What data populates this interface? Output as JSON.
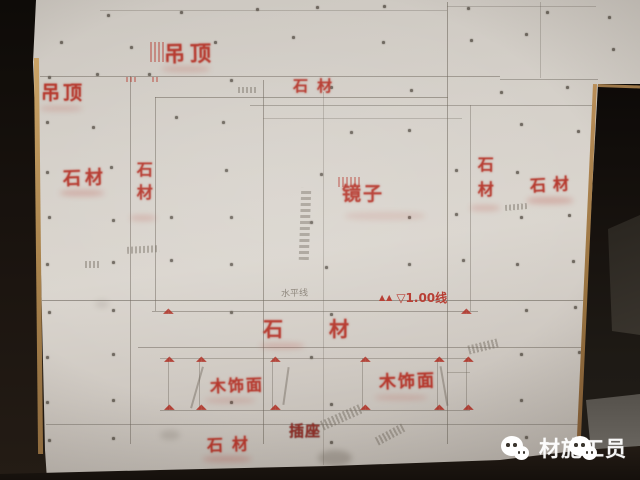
{
  "colors": {
    "stencil_red": "#b5372c",
    "stencil_dark_red": "#8f2d26",
    "pencil_gray": "#6f675c",
    "wall_light": "#dad5ce",
    "wall_dark": "#b3ada6",
    "shadow_black": "#16110d",
    "wood_trim": "#a8824c",
    "floor_gray": "#6a6660",
    "watermark_white": "#ffffff"
  },
  "stencil_labels": [
    {
      "id": "diaoding-top",
      "text": "吊顶",
      "x": 164,
      "y": 43,
      "fs": 21,
      "ls": 5,
      "rot": -1
    },
    {
      "id": "diaoding-left",
      "text": "吊顶",
      "x": 41,
      "y": 84,
      "fs": 19,
      "ls": 3,
      "rot": 0
    },
    {
      "id": "shicai-top",
      "text": "石材",
      "x": 293,
      "y": 79,
      "fs": 15,
      "ls": 9,
      "rot": 0
    },
    {
      "id": "shicai-left-horizontal",
      "text": "石材",
      "x": 63,
      "y": 170,
      "fs": 18,
      "ls": 4,
      "rot": -2
    },
    {
      "id": "shicai-left-vertical",
      "text": "石材",
      "x": 134,
      "y": 161,
      "fs": 16,
      "ls": 7,
      "vert": true
    },
    {
      "id": "jingzi-mirror",
      "text": "镜子",
      "x": 342,
      "y": 185,
      "fs": 19,
      "ls": 2,
      "rot": 0
    },
    {
      "id": "shicai-right-vertical",
      "text": "石材",
      "x": 475,
      "y": 156,
      "fs": 16,
      "ls": 9,
      "vert": true
    },
    {
      "id": "shicai-right-horizontal",
      "text": "石材",
      "x": 530,
      "y": 177,
      "fs": 16,
      "ls": 7,
      "rot": -3
    },
    {
      "id": "shicai-middle-band",
      "text": "石材",
      "x": 263,
      "y": 319,
      "fs": 20,
      "ls": 46,
      "rot": 0
    },
    {
      "id": "mushimian-left",
      "text": "木饰面",
      "x": 210,
      "y": 378,
      "fs": 16,
      "ls": 2,
      "rot": -2
    },
    {
      "id": "mushimian-right",
      "text": "木饰面",
      "x": 379,
      "y": 374,
      "fs": 17,
      "ls": 2,
      "rot": -2
    },
    {
      "id": "chazuo-socket",
      "text": "插座",
      "x": 289,
      "y": 424,
      "fs": 15,
      "ls": 1,
      "rot": 0,
      "dark": true
    },
    {
      "id": "shicai-bottom",
      "text": "石材",
      "x": 207,
      "y": 437,
      "fs": 16,
      "ls": 9,
      "rot": -2
    }
  ],
  "level_mark": {
    "symbols": "▲▲",
    "text": "▽1.00线"
  },
  "pencil_note": {
    "text": "水平线"
  },
  "watermark": {
    "text": "材施工员",
    "icons": [
      "wechat-icon",
      "wechat-icon"
    ]
  },
  "wall": {
    "corner_mark_glyph": "◢◣",
    "corner_marks": [
      [
        163,
        308
      ],
      [
        461,
        308
      ],
      [
        164,
        356
      ],
      [
        196,
        356
      ],
      [
        270,
        356
      ],
      [
        360,
        356
      ],
      [
        434,
        356
      ],
      [
        463,
        356
      ],
      [
        164,
        404
      ],
      [
        196,
        404
      ],
      [
        270,
        404
      ],
      [
        360,
        404
      ],
      [
        434,
        404
      ],
      [
        463,
        404
      ]
    ],
    "lines_h": [
      [
        10,
        100,
        447,
        0.3
      ],
      [
        6,
        447,
        596,
        0.3
      ],
      [
        76,
        40,
        500,
        0.5
      ],
      [
        79,
        500,
        598,
        0.45
      ],
      [
        97,
        155,
        448,
        0.55
      ],
      [
        105,
        250,
        592,
        0.45
      ],
      [
        118,
        263,
        462,
        0.3
      ],
      [
        300,
        42,
        590,
        0.6
      ],
      [
        311,
        152,
        478,
        0.5
      ],
      [
        347,
        138,
        588,
        0.5
      ],
      [
        358,
        160,
        470,
        0.4
      ],
      [
        372,
        447,
        470,
        0.35
      ],
      [
        410,
        160,
        470,
        0.45
      ],
      [
        424,
        46,
        580,
        0.45
      ]
    ],
    "lines_v": [
      [
        130,
        76,
        444,
        0.5
      ],
      [
        155,
        97,
        311,
        0.5
      ],
      [
        263,
        80,
        444,
        0.55
      ],
      [
        323,
        92,
        465,
        0.3
      ],
      [
        447,
        2,
        444,
        0.55
      ],
      [
        470,
        105,
        311,
        0.4
      ],
      [
        540,
        2,
        78,
        0.3
      ],
      [
        168,
        358,
        410,
        0.4
      ],
      [
        199,
        358,
        410,
        0.4
      ],
      [
        272,
        358,
        410,
        0.4
      ],
      [
        362,
        358,
        410,
        0.4
      ],
      [
        437,
        358,
        410,
        0.4
      ],
      [
        466,
        358,
        410,
        0.4
      ]
    ],
    "screws": [
      [
        107,
        14
      ],
      [
        180,
        11
      ],
      [
        256,
        8
      ],
      [
        316,
        6
      ],
      [
        383,
        5
      ],
      [
        467,
        7
      ],
      [
        546,
        11
      ],
      [
        608,
        16
      ],
      [
        60,
        41
      ],
      [
        130,
        46
      ],
      [
        214,
        41
      ],
      [
        292,
        36
      ],
      [
        382,
        41
      ],
      [
        470,
        39
      ],
      [
        525,
        33
      ],
      [
        612,
        48
      ],
      [
        48,
        76
      ],
      [
        96,
        73
      ],
      [
        148,
        73
      ],
      [
        230,
        79
      ],
      [
        330,
        86
      ],
      [
        410,
        89
      ],
      [
        500,
        91
      ],
      [
        566,
        86
      ],
      [
        46,
        121
      ],
      [
        92,
        126
      ],
      [
        175,
        116
      ],
      [
        222,
        121
      ],
      [
        350,
        131
      ],
      [
        408,
        129
      ],
      [
        520,
        123
      ],
      [
        577,
        130
      ],
      [
        46,
        171
      ],
      [
        110,
        166
      ],
      [
        225,
        169
      ],
      [
        320,
        173
      ],
      [
        455,
        169
      ],
      [
        516,
        171
      ],
      [
        48,
        216
      ],
      [
        112,
        219
      ],
      [
        170,
        216
      ],
      [
        230,
        216
      ],
      [
        310,
        221
      ],
      [
        408,
        216
      ],
      [
        455,
        213
      ],
      [
        520,
        216
      ],
      [
        568,
        214
      ],
      [
        46,
        263
      ],
      [
        112,
        261
      ],
      [
        170,
        259
      ],
      [
        230,
        263
      ],
      [
        325,
        266
      ],
      [
        408,
        263
      ],
      [
        462,
        259
      ],
      [
        516,
        263
      ],
      [
        572,
        260
      ],
      [
        48,
        311
      ],
      [
        112,
        309
      ],
      [
        230,
        311
      ],
      [
        330,
        313
      ],
      [
        525,
        309
      ],
      [
        574,
        306
      ],
      [
        46,
        356
      ],
      [
        112,
        353
      ],
      [
        310,
        356
      ],
      [
        520,
        353
      ],
      [
        578,
        351
      ],
      [
        46,
        401
      ],
      [
        112,
        399
      ],
      [
        230,
        401
      ],
      [
        330,
        403
      ],
      [
        520,
        399
      ],
      [
        48,
        439
      ],
      [
        112,
        437
      ],
      [
        330,
        441
      ],
      [
        525,
        436
      ]
    ],
    "smears": [
      [
        60,
        190,
        44,
        6,
        0.25
      ],
      [
        130,
        215,
        26,
        6,
        0.2
      ],
      [
        345,
        212,
        80,
        8,
        0.12
      ],
      [
        527,
        197,
        46,
        7,
        0.25
      ],
      [
        470,
        205,
        30,
        6,
        0.2
      ],
      [
        162,
        66,
        48,
        6,
        0.2
      ],
      [
        40,
        106,
        42,
        5,
        0.2
      ],
      [
        260,
        343,
        44,
        6,
        0.2
      ],
      [
        203,
        456,
        48,
        6,
        0.25
      ],
      [
        205,
        398,
        50,
        5,
        0.18
      ],
      [
        375,
        395,
        52,
        5,
        0.18
      ]
    ],
    "stains": [
      [
        318,
        450,
        34,
        16,
        0.35
      ],
      [
        160,
        430,
        20,
        10,
        0.2
      ],
      [
        95,
        300,
        14,
        8,
        0.15
      ]
    ],
    "scribbles": [
      {
        "x": 300,
        "y": 188,
        "w": 10,
        "h": 72,
        "rot": 2,
        "vert": true
      },
      {
        "x": 127,
        "y": 246,
        "w": 32,
        "h": 7,
        "rot": -3
      },
      {
        "x": 85,
        "y": 261,
        "w": 14,
        "h": 7,
        "rot": 0
      },
      {
        "x": 238,
        "y": 87,
        "w": 18,
        "h": 6,
        "rot": 0
      },
      {
        "x": 505,
        "y": 204,
        "w": 22,
        "h": 6,
        "rot": -5
      },
      {
        "x": 320,
        "y": 412,
        "w": 44,
        "h": 10,
        "rot": -24
      },
      {
        "x": 468,
        "y": 342,
        "w": 30,
        "h": 9,
        "rot": -14
      },
      {
        "x": 375,
        "y": 430,
        "w": 30,
        "h": 9,
        "rot": -28
      },
      {
        "x": 338,
        "y": 177,
        "w": 24,
        "h": 10,
        "rot": 0,
        "red": true
      },
      {
        "x": 150,
        "y": 42,
        "w": 16,
        "h": 20,
        "rot": 0,
        "red": true,
        "vert": true
      },
      {
        "x": 126,
        "y": 77,
        "w": 10,
        "h": 5,
        "rot": 0,
        "red": true
      },
      {
        "x": 152,
        "y": 77,
        "w": 8,
        "h": 5,
        "rot": 0,
        "red": true
      },
      {
        "x": 196,
        "y": 366,
        "w": 2,
        "h": 43,
        "rot": 16,
        "solid": true
      },
      {
        "x": 285,
        "y": 367,
        "w": 2,
        "h": 38,
        "rot": 8,
        "solid": true
      },
      {
        "x": 443,
        "y": 366,
        "w": 2,
        "h": 40,
        "rot": -10,
        "solid": true
      }
    ]
  }
}
